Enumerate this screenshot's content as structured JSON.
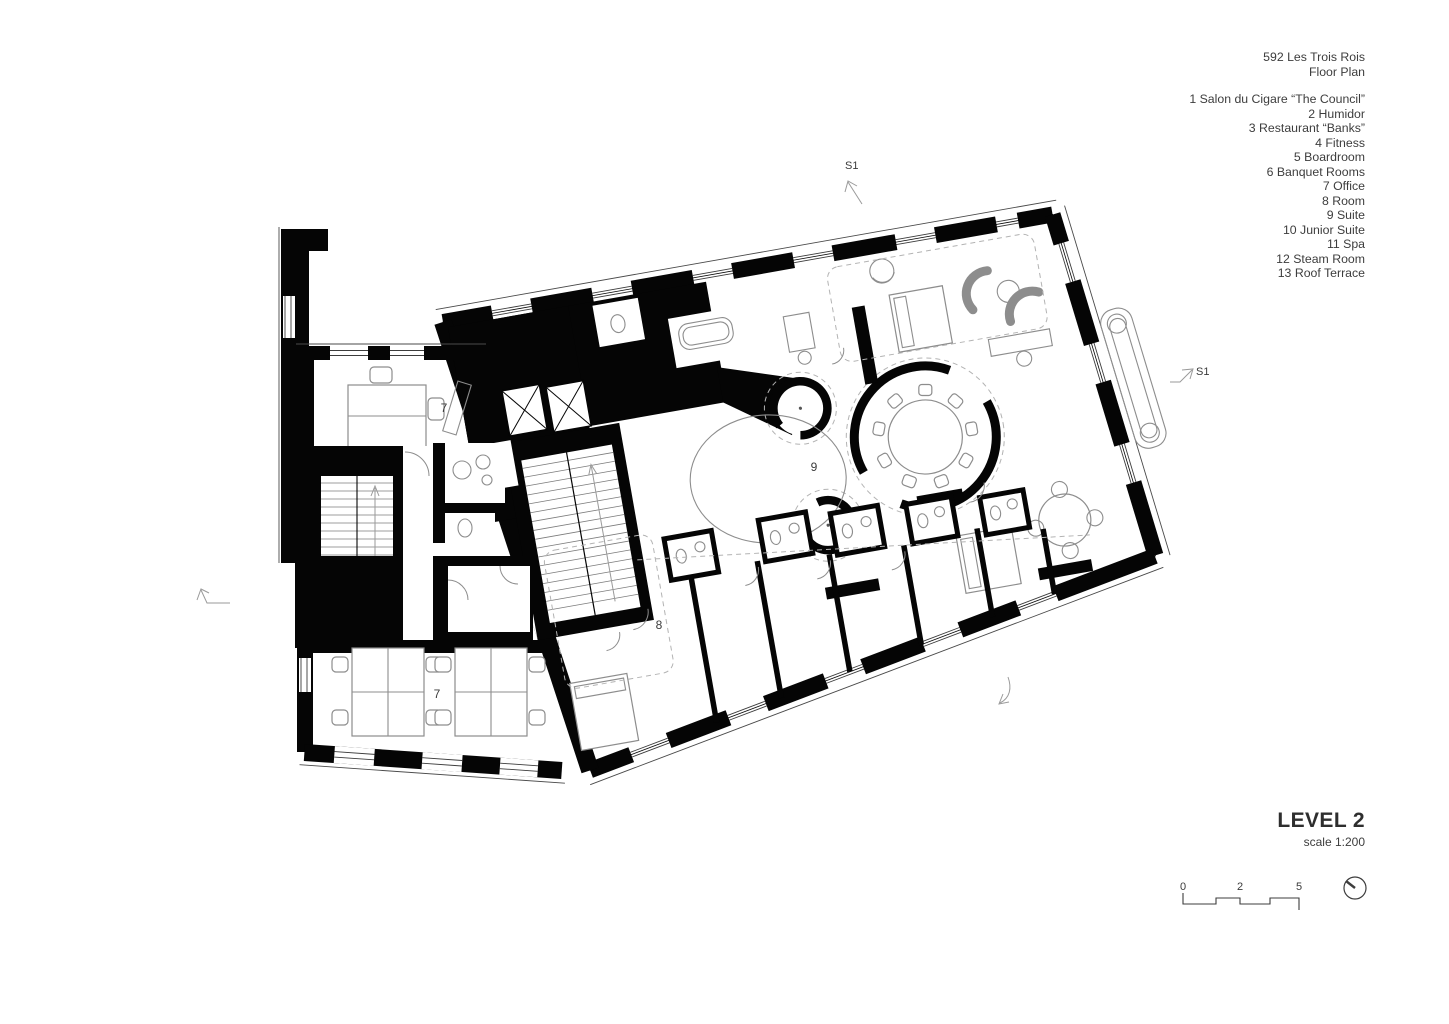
{
  "header": {
    "title": "592 Les Trois Rois",
    "subtitle": "Floor Plan"
  },
  "legend": {
    "items": [
      "1 Salon du Cigare “The Council”",
      "2 Humidor",
      "3 Restaurant “Banks”",
      "4 Fitness",
      "5 Boardroom",
      "6 Banquet Rooms",
      "7 Office",
      "8 Room",
      "9 Suite",
      "10 Junior Suite",
      "11 Spa",
      "12 Steam Room",
      "13 Roof Terrace"
    ]
  },
  "plan": {
    "room_labels": [
      {
        "room": "office-upper",
        "text": "7"
      },
      {
        "room": "office-lower",
        "text": "7"
      },
      {
        "room": "room-8",
        "text": "8"
      },
      {
        "room": "suite-9",
        "text": "9"
      }
    ],
    "section_markers": [
      {
        "position": "top",
        "text": "S1"
      },
      {
        "position": "right",
        "text": "S1"
      }
    ]
  },
  "footer": {
    "level_title": "LEVEL 2",
    "scale_note": "scale 1:200",
    "scale_bar_labels": [
      "0",
      "2",
      "5"
    ]
  },
  "colors": {
    "background": "#ffffff",
    "wall": "#000000",
    "furniture_line": "#8d8d8d",
    "text": "#3d3d3d"
  }
}
